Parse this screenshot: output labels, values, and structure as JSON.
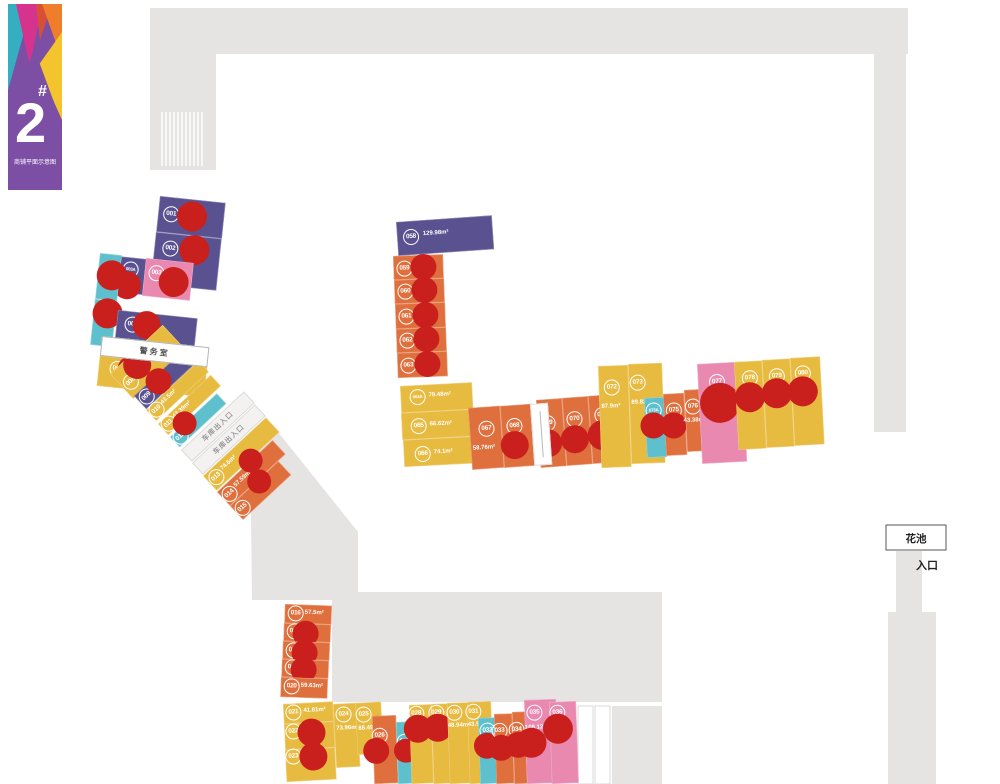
{
  "logo": {
    "building_number": "2",
    "hash": "#",
    "subtitle": "商铺平面示意图"
  },
  "palette": {
    "purple": "#5a5290",
    "orange": "#df6f3d",
    "yellow": "#e7ba40",
    "teal": "#5fc0cd",
    "pink": "#e989af",
    "sold_marker": "#c9201e",
    "structure": "#e5e4e3"
  },
  "landmarks": {
    "guard_room": "警务室",
    "garage_strip1": "车库出入口",
    "garage_strip2": "车库出入口",
    "flower_bed": "花池",
    "entrance": "入口"
  },
  "shops": [
    {
      "id": "001",
      "x": 160,
      "y": 196,
      "w": 66,
      "h": 36,
      "rot": 6,
      "color": "purple",
      "badge": [
        13,
        17
      ],
      "dots": [
        [
          34,
          17,
          15
        ]
      ]
    },
    {
      "id": "002",
      "x": 156,
      "y": 232,
      "w": 66,
      "h": 52,
      "rot": 6,
      "color": "purple",
      "badge": [
        16,
        15
      ],
      "dots": [
        [
          40,
          14,
          15
        ]
      ]
    },
    {
      "id": "003A",
      "x": 117,
      "y": 256,
      "w": 30,
      "h": 36,
      "rot": 6,
      "color": "purple",
      "badge": [
        15,
        12
      ],
      "dots": [
        [
          13,
          28,
          14
        ]
      ]
    },
    {
      "id": "003",
      "x": 146,
      "y": 258,
      "w": 48,
      "h": 38,
      "rot": 6,
      "color": "pink",
      "badge": [
        12,
        14
      ],
      "dots": [
        [
          30,
          21,
          15
        ]
      ]
    },
    {
      "id": "004",
      "x": 100,
      "y": 253,
      "w": 22,
      "h": 46,
      "rot": 6,
      "color": "teal",
      "badge": [
        11,
        15
      ],
      "dots": [
        [
          14,
          21,
          15
        ]
      ]
    },
    {
      "id": "005",
      "x": 95,
      "y": 299,
      "w": 22,
      "h": 46,
      "rot": 6,
      "color": "teal",
      "badge": [
        11,
        9
      ],
      "dots": [
        [
          14,
          13,
          15
        ]
      ]
    },
    {
      "id": "006",
      "x": 118,
      "y": 310,
      "w": 80,
      "h": 28,
      "rot": 6,
      "color": "purple",
      "badge": [
        16,
        13
      ],
      "dots": [
        [
          30,
          12,
          14
        ]
      ]
    },
    {
      "id": "007",
      "x": 100,
      "y": 354,
      "w": 108,
      "h": 32,
      "rot": 6,
      "color": "yellow",
      "badge": [
        19,
        13
      ],
      "dots": [
        [
          33,
          12,
          14
        ]
      ]
    },
    {
      "id": "008",
      "x": 110,
      "y": 374,
      "w": 72,
      "h": 34,
      "rot": -43,
      "color": "yellow",
      "badge": [
        10,
        20
      ],
      "dots": [
        [
          26,
          12,
          14
        ]
      ]
    },
    {
      "id": "009",
      "x": 134,
      "y": 396,
      "w": 74,
      "h": 18,
      "rot": -43,
      "color": "purple",
      "badge": [
        9,
        9
      ],
      "dots": [
        [
          28,
          6,
          13
        ]
      ]
    },
    {
      "id": "010",
      "x": 146,
      "y": 410,
      "w": 72,
      "h": 15,
      "rot": -43,
      "color": "yellow",
      "badge": [
        8,
        7
      ],
      "area": "43.5m²",
      "area_xy": [
        16,
        3
      ]
    },
    {
      "id": "011",
      "x": 158,
      "y": 424,
      "w": 72,
      "h": 15,
      "rot": -43,
      "color": "yellow",
      "badge": [
        8,
        7
      ],
      "area": "43.39m²",
      "area_xy": [
        16,
        3
      ]
    },
    {
      "id": "012",
      "x": 170,
      "y": 437,
      "w": 64,
      "h": 14,
      "rot": -43,
      "color": "teal",
      "badge": [
        8,
        7
      ],
      "dots": [
        [
          20,
          0,
          12
        ]
      ]
    },
    {
      "id": "013",
      "x": 203,
      "y": 476,
      "w": 86,
      "h": 20,
      "rot": -43,
      "color": "yellow",
      "badge": [
        9,
        10
      ],
      "area": "74.6m²",
      "area_xy": [
        18,
        5
      ]
    },
    {
      "id": "014",
      "x": 217,
      "y": 492,
      "w": 76,
      "h": 19,
      "rot": -43,
      "color": "orange",
      "badge": [
        8,
        10
      ],
      "area": "57.59m²",
      "area_xy": [
        17,
        5
      ],
      "dots": [
        [
          46,
          0,
          12
        ]
      ]
    },
    {
      "id": "015",
      "x": 230,
      "y": 506,
      "w": 66,
      "h": 19,
      "rot": -43,
      "color": "orange",
      "badge": [
        8,
        10
      ],
      "dots": [
        [
          38,
          2,
          12
        ]
      ]
    },
    {
      "id": "016",
      "x": 285,
      "y": 604,
      "w": 47,
      "h": 19,
      "rot": 2,
      "color": "orange",
      "badge": [
        11,
        9
      ],
      "area": "57.5m²",
      "area_xy": [
        20,
        5
      ]
    },
    {
      "id": "017",
      "x": 284,
      "y": 623,
      "w": 47,
      "h": 18,
      "rot": 2,
      "color": "orange",
      "badge": [
        11,
        8
      ],
      "dots": [
        [
          22,
          10,
          13
        ]
      ]
    },
    {
      "id": "018",
      "x": 283,
      "y": 641,
      "w": 47,
      "h": 18,
      "rot": 2,
      "color": "orange",
      "badge": [
        11,
        9
      ],
      "dots": [
        [
          22,
          11,
          13
        ]
      ]
    },
    {
      "id": "019",
      "x": 282,
      "y": 659,
      "w": 47,
      "h": 18,
      "rot": 2,
      "color": "orange",
      "badge": [
        11,
        8
      ],
      "dots": [
        [
          22,
          10,
          13
        ]
      ]
    },
    {
      "id": "020",
      "x": 281,
      "y": 677,
      "w": 47,
      "h": 20,
      "rot": 2,
      "color": "orange",
      "badge": [
        11,
        9
      ],
      "area": "59.63m²",
      "area_xy": [
        20,
        5
      ]
    },
    {
      "id": "021",
      "x": 283,
      "y": 704,
      "w": 50,
      "h": 20,
      "rot": -3,
      "color": "yellow",
      "badge": [
        10,
        9
      ],
      "area": "41.81m²",
      "area_xy": [
        20,
        5
      ]
    },
    {
      "id": "022",
      "x": 284,
      "y": 724,
      "w": 50,
      "h": 26,
      "rot": -3,
      "color": "yellow",
      "badge": [
        9,
        8
      ],
      "dots": [
        [
          27,
          10,
          14
        ]
      ]
    },
    {
      "id": "023",
      "x": 285,
      "y": 750,
      "w": 50,
      "h": 32,
      "rot": -3,
      "color": "yellow",
      "badge": [
        8,
        7
      ],
      "dots": [
        [
          28,
          8,
          14
        ]
      ]
    },
    {
      "id": "024",
      "x": 333,
      "y": 704,
      "w": 24,
      "h": 64,
      "rot": -3,
      "color": "yellow",
      "badge": [
        10,
        11
      ],
      "area": "73.96m²",
      "area_xy": [
        2,
        22
      ]
    },
    {
      "id": "025",
      "x": 355,
      "y": 703,
      "w": 26,
      "h": 52,
      "rot": -3,
      "color": "yellow",
      "badge": [
        8,
        12
      ],
      "area": "88.49m²",
      "area_xy": [
        2,
        23
      ]
    },
    {
      "id": "026",
      "x": 372,
      "y": 716,
      "w": 24,
      "h": 68,
      "rot": -2,
      "color": "orange",
      "badge": [
        7,
        20
      ],
      "dots": [
        [
          3,
          35,
          13
        ]
      ]
    },
    {
      "id": "027",
      "x": 396,
      "y": 722,
      "w": 18,
      "h": 62,
      "rot": -2,
      "color": "teal",
      "badge": [
        8,
        20
      ],
      "dots": [
        [
          9,
          29,
          12
        ]
      ]
    },
    {
      "id": "028",
      "x": 409,
      "y": 705,
      "w": 22,
      "h": 79,
      "rot": -2,
      "color": "yellow",
      "badge": [
        7,
        9
      ],
      "dots": [
        [
          8,
          24,
          14
        ]
      ]
    },
    {
      "id": "029",
      "x": 431,
      "y": 704,
      "w": 22,
      "h": 80,
      "rot": -2,
      "color": "yellow",
      "badge": [
        5,
        9
      ],
      "dots": [
        [
          6,
          24,
          14
        ]
      ]
    },
    {
      "id": "030",
      "x": 447,
      "y": 703,
      "w": 22,
      "h": 81,
      "rot": -2,
      "color": "yellow",
      "badge": [
        7,
        10
      ],
      "area": "48.94m²",
      "area_xy": [
        0,
        20
      ]
    },
    {
      "id": "031",
      "x": 467,
      "y": 702,
      "w": 24,
      "h": 82,
      "rot": -2,
      "color": "yellow",
      "badge": [
        6,
        10
      ],
      "area": "43.98m²",
      "area_xy": [
        0,
        20
      ]
    },
    {
      "id": "032",
      "x": 478,
      "y": 718,
      "w": 18,
      "h": 66,
      "rot": -2,
      "color": "teal",
      "badge": [
        9,
        13
      ],
      "dots": [
        [
          8,
          28,
          13
        ]
      ]
    },
    {
      "id": "033",
      "x": 494,
      "y": 714,
      "w": 18,
      "h": 70,
      "rot": -2,
      "color": "orange",
      "badge": [
        5,
        17
      ],
      "dots": [
        [
          6,
          34,
          13
        ]
      ]
    },
    {
      "id": "034",
      "x": 512,
      "y": 712,
      "w": 18,
      "h": 72,
      "rot": -2,
      "color": "orange",
      "badge": [
        4,
        18
      ],
      "dots": [
        [
          5,
          33,
          13
        ]
      ]
    },
    {
      "id": "035",
      "x": 524,
      "y": 700,
      "w": 32,
      "h": 84,
      "rot": -2,
      "color": "pink",
      "badge": [
        10,
        13
      ],
      "area": "108.12m²",
      "area_xy": [
        0,
        25
      ],
      "dots": [
        [
          6,
          43,
          15
        ]
      ]
    },
    {
      "id": "036",
      "x": 549,
      "y": 702,
      "w": 27,
      "h": 82,
      "rot": -2,
      "color": "pink",
      "badge": [
        8,
        11
      ],
      "dots": [
        [
          8,
          27,
          15
        ]
      ]
    },
    {
      "id": "058",
      "x": 396,
      "y": 222,
      "w": 96,
      "h": 34,
      "rot": -4,
      "color": "purple",
      "badge": [
        14,
        16
      ],
      "area": "129.98m²",
      "area_xy": [
        26,
        11
      ]
    },
    {
      "id": "059",
      "x": 393,
      "y": 256,
      "w": 50,
      "h": 24,
      "rot": -2,
      "color": "orange",
      "badge": [
        11,
        13
      ],
      "dots": [
        [
          30,
          12,
          13
        ]
      ]
    },
    {
      "id": "060",
      "x": 394,
      "y": 280,
      "w": 50,
      "h": 24,
      "rot": -2,
      "color": "orange",
      "badge": [
        11,
        12
      ],
      "dots": [
        [
          30,
          11,
          13
        ]
      ]
    },
    {
      "id": "061",
      "x": 395,
      "y": 304,
      "w": 50,
      "h": 25,
      "rot": -2,
      "color": "orange",
      "badge": [
        11,
        13
      ],
      "dots": [
        [
          30,
          12,
          13
        ]
      ]
    },
    {
      "id": "062",
      "x": 396,
      "y": 329,
      "w": 50,
      "h": 24,
      "rot": -2,
      "color": "orange",
      "badge": [
        11,
        12
      ],
      "dots": [
        [
          30,
          11,
          13
        ]
      ]
    },
    {
      "id": "063",
      "x": 397,
      "y": 353,
      "w": 50,
      "h": 25,
      "rot": -2,
      "color": "orange",
      "badge": [
        11,
        13
      ],
      "dots": [
        [
          30,
          12,
          13
        ]
      ]
    },
    {
      "id": "064A",
      "x": 400,
      "y": 386,
      "w": 72,
      "h": 27,
      "rot": -3,
      "color": "yellow",
      "badge": [
        17,
        12
      ],
      "area": "79.48m²",
      "area_xy": [
        28,
        8
      ]
    },
    {
      "id": "065",
      "x": 401,
      "y": 413,
      "w": 72,
      "h": 27,
      "rot": -3,
      "color": "yellow",
      "badge": [
        17,
        14
      ],
      "area": "66.62m²",
      "area_xy": [
        28,
        10
      ]
    },
    {
      "id": "066",
      "x": 403,
      "y": 440,
      "w": 72,
      "h": 27,
      "rot": -3,
      "color": "yellow",
      "badge": [
        19,
        15
      ],
      "area": "74.1m²",
      "area_xy": [
        30,
        11
      ]
    },
    {
      "id": "067",
      "x": 468,
      "y": 408,
      "w": 32,
      "h": 62,
      "rot": -4,
      "color": "orange",
      "badge": [
        17,
        22
      ],
      "area": "58.76m²",
      "area_xy": [
        2,
        38
      ]
    },
    {
      "id": "068",
      "x": 500,
      "y": 406,
      "w": 32,
      "h": 62,
      "rot": -4,
      "color": "orange",
      "badge": [
        13,
        21
      ],
      "dots": [
        [
          12,
          40,
          14
        ]
      ]
    },
    {
      "id": "069",
      "x": 536,
      "y": 400,
      "w": 26,
      "h": 68,
      "rot": -4,
      "color": "orange",
      "badge": [
        10,
        24
      ],
      "dots": [
        [
          9,
          44,
          14
        ]
      ]
    },
    {
      "id": "070",
      "x": 562,
      "y": 398,
      "w": 26,
      "h": 68,
      "rot": -4,
      "color": "orange",
      "badge": [
        11,
        22
      ],
      "dots": [
        [
          10,
          42,
          14
        ]
      ]
    },
    {
      "id": "071",
      "x": 588,
      "y": 396,
      "w": 26,
      "h": 68,
      "rot": -4,
      "color": "orange",
      "badge": [
        13,
        20
      ],
      "dots": [
        [
          12,
          40,
          15
        ]
      ]
    },
    {
      "id": "072",
      "x": 598,
      "y": 366,
      "w": 30,
      "h": 102,
      "rot": -2,
      "color": "yellow",
      "badge": [
        13,
        22
      ],
      "area": "87.9m²",
      "area_xy": [
        2,
        38
      ]
    },
    {
      "id": "073",
      "x": 628,
      "y": 364,
      "w": 34,
      "h": 100,
      "rot": -2,
      "color": "yellow",
      "badge": [
        9,
        19
      ],
      "area": "89.82m²",
      "area_xy": [
        2,
        36
      ]
    },
    {
      "id": "073A",
      "x": 644,
      "y": 398,
      "w": 20,
      "h": 60,
      "rot": -3,
      "color": "teal",
      "badge": [
        9,
        13
      ],
      "dots": [
        [
          8,
          28,
          13
        ]
      ]
    },
    {
      "id": "075",
      "x": 663,
      "y": 394,
      "w": 21,
      "h": 62,
      "rot": -3,
      "color": "orange",
      "badge": [
        10,
        17
      ],
      "dots": [
        [
          9,
          32,
          13
        ]
      ]
    },
    {
      "id": "076",
      "x": 684,
      "y": 390,
      "w": 24,
      "h": 62,
      "rot": -3,
      "color": "orange",
      "badge": [
        8,
        17
      ],
      "area": "43.38m²",
      "area_xy": [
        -2,
        28
      ]
    },
    {
      "id": "077",
      "x": 697,
      "y": 364,
      "w": 45,
      "h": 100,
      "rot": -3,
      "color": "pink",
      "badge": [
        19,
        19
      ],
      "dots": [
        [
          21,
          40,
          20
        ]
      ]
    },
    {
      "id": "078",
      "x": 734,
      "y": 362,
      "w": 28,
      "h": 88,
      "rot": -3,
      "color": "yellow",
      "badge": [
        15,
        17
      ],
      "dots": [
        [
          14,
          36,
          15
        ]
      ]
    },
    {
      "id": "079",
      "x": 762,
      "y": 360,
      "w": 28,
      "h": 88,
      "rot": -3,
      "color": "yellow",
      "badge": [
        14,
        17
      ],
      "dots": [
        [
          13,
          34,
          15
        ]
      ]
    },
    {
      "id": "080",
      "x": 790,
      "y": 358,
      "w": 30,
      "h": 88,
      "rot": -3,
      "color": "yellow",
      "badge": [
        12,
        16
      ],
      "dots": [
        [
          11,
          34,
          15
        ]
      ]
    }
  ]
}
